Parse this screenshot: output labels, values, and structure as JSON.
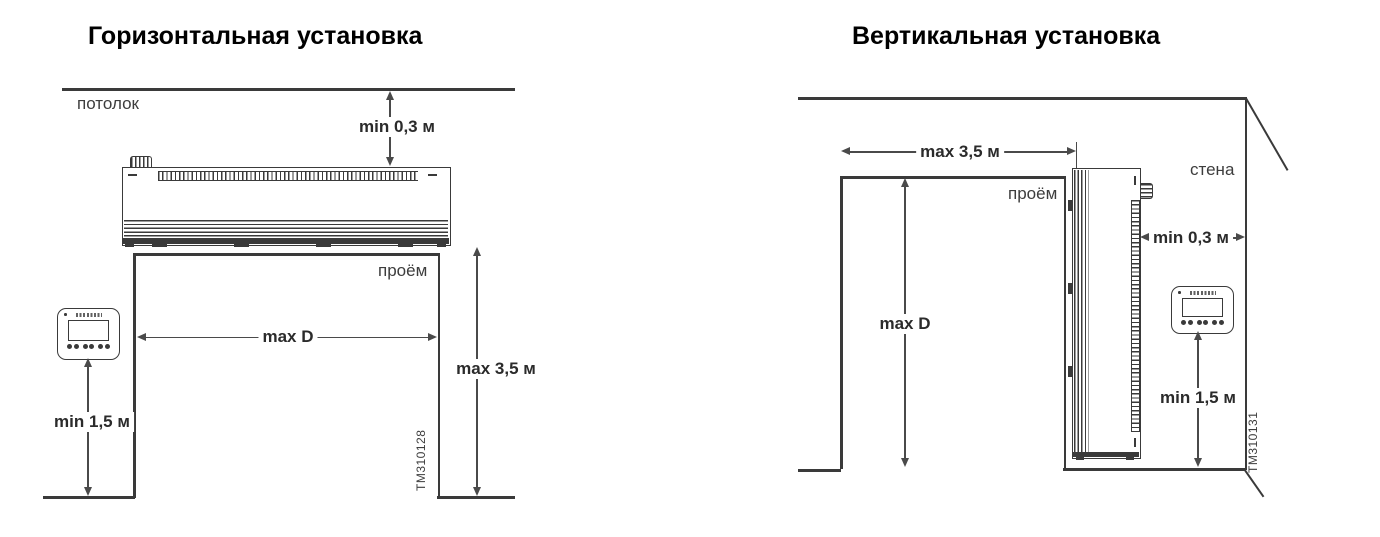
{
  "colors": {
    "line": "#3a3a3a",
    "text": "#2b2b2b",
    "background": "#ffffff"
  },
  "horizontal_panel": {
    "title": "Горизонтальная установка",
    "ceiling_label": "потолок",
    "opening_label": "проём",
    "dim_ceiling_gap": "min 0,3 м",
    "dim_opening_width": "max D",
    "dim_mount_height": "max 3,5 м",
    "dim_controller_height": "min 1,5 м",
    "drawing_id": "TM310128"
  },
  "vertical_panel": {
    "title": "Вертикальная установка",
    "wall_label": "стена",
    "opening_label": "проём",
    "dim_jet_reach": "max 3,5 м",
    "dim_wall_gap": "min 0,3 м",
    "dim_opening_height": "max D",
    "dim_controller_height": "min 1,5 м",
    "drawing_id": "TM310131"
  }
}
